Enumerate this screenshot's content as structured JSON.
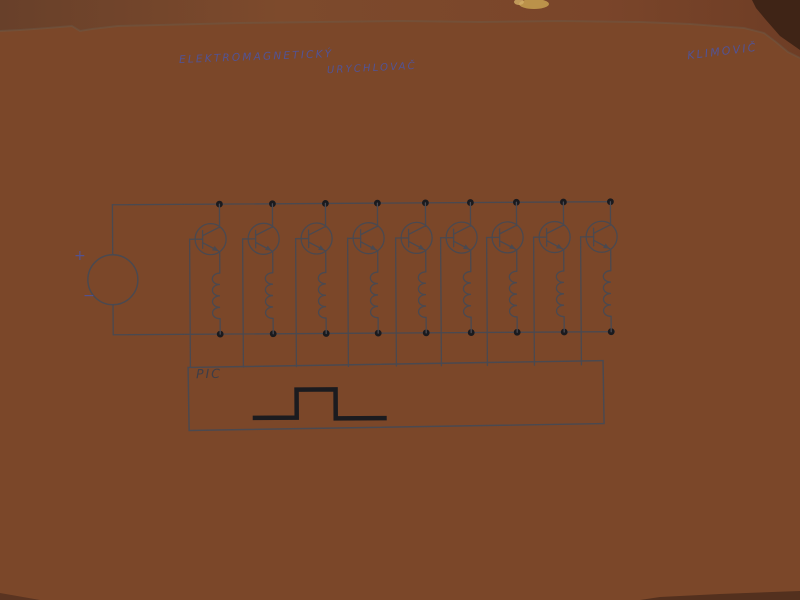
{
  "annotations": {
    "title_line1": "ELEKTROMAGNETICKÝ",
    "title_line2": "URYCHLOVAČ",
    "author": "KLIMOVIČ",
    "ink_color": "#4c55a4"
  },
  "schematic": {
    "kind": "hand-drawn circuit diagram",
    "source": {
      "plus_label": "+",
      "minus_label": "−"
    },
    "controller": {
      "label": "PIC"
    },
    "stage_count": 9,
    "stage_x": [
      220,
      273,
      326,
      378,
      426,
      471,
      517,
      564,
      611
    ],
    "rails": {
      "top_y": 203,
      "bottom_y": 333,
      "left_x": 113
    },
    "source_geometry": {
      "cx": 113,
      "cy": 278,
      "r": 25
    },
    "controller_box": {
      "x": 188,
      "y": 364,
      "width": 415,
      "height": 63
    },
    "pulse_points": [
      [
        252,
        417
      ],
      [
        296,
        417
      ],
      [
        296,
        389
      ],
      [
        335,
        389
      ],
      [
        335,
        418
      ],
      [
        386,
        418
      ]
    ],
    "ink_color": "#4a4950",
    "dot_color": "#1a1a1e",
    "pulse_color": "#1b1b1f"
  },
  "environment": {
    "table_color": "#7b4729",
    "paper_color": "#e2dfda"
  }
}
